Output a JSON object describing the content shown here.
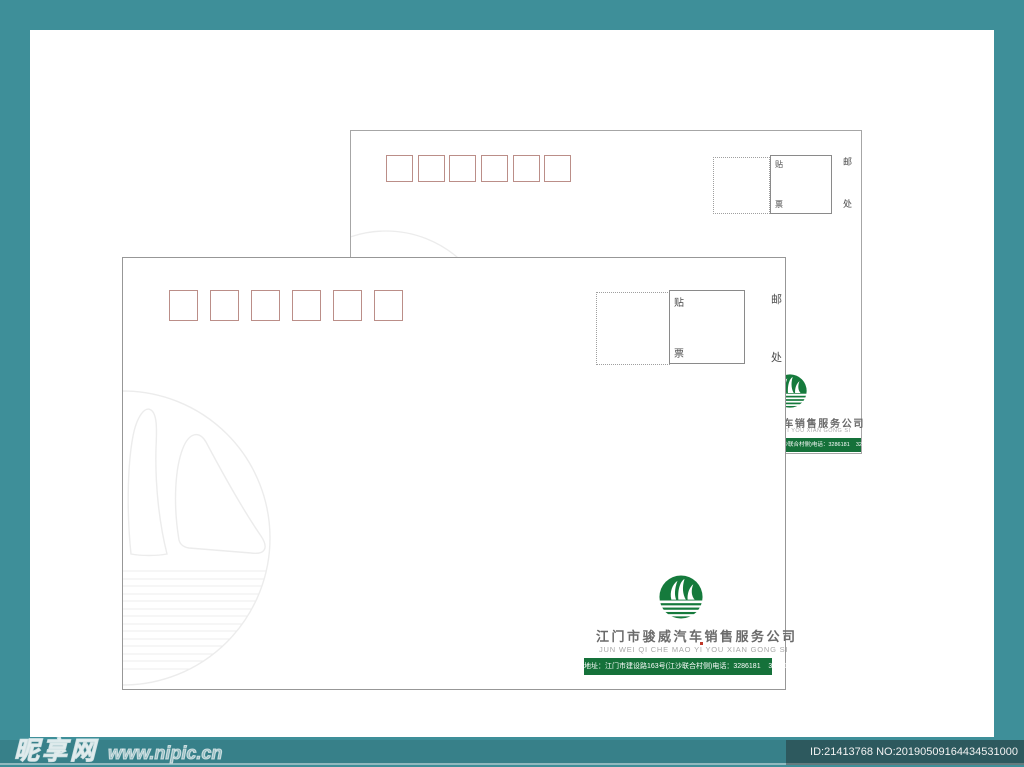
{
  "site": {
    "watermark_brand": "昵享网",
    "watermark_url": "www.nipic.cn",
    "image_id": "ID:21413768 NO:20190509164434531000"
  },
  "envelope": {
    "postal_box_count": 6,
    "stamp": {
      "tie": "贴",
      "piao": "票",
      "you": "邮",
      "chu": "处"
    },
    "company_name": "江门市骏威汽车销售服务公司",
    "company_pinyin": "JUN WEI QI CHE MAO YI YOU XIAN GONG SI",
    "address_bar": "地址：江门市建设路163号(江沙联合村侧)电话：3286181    3286182"
  },
  "colors": {
    "teal_background": "#3E8F99",
    "brand_green": "#15713A",
    "postal_box_red": "#BB8E88",
    "envelope_border_gray": "#979797",
    "watermark_gray": "#ececec"
  }
}
